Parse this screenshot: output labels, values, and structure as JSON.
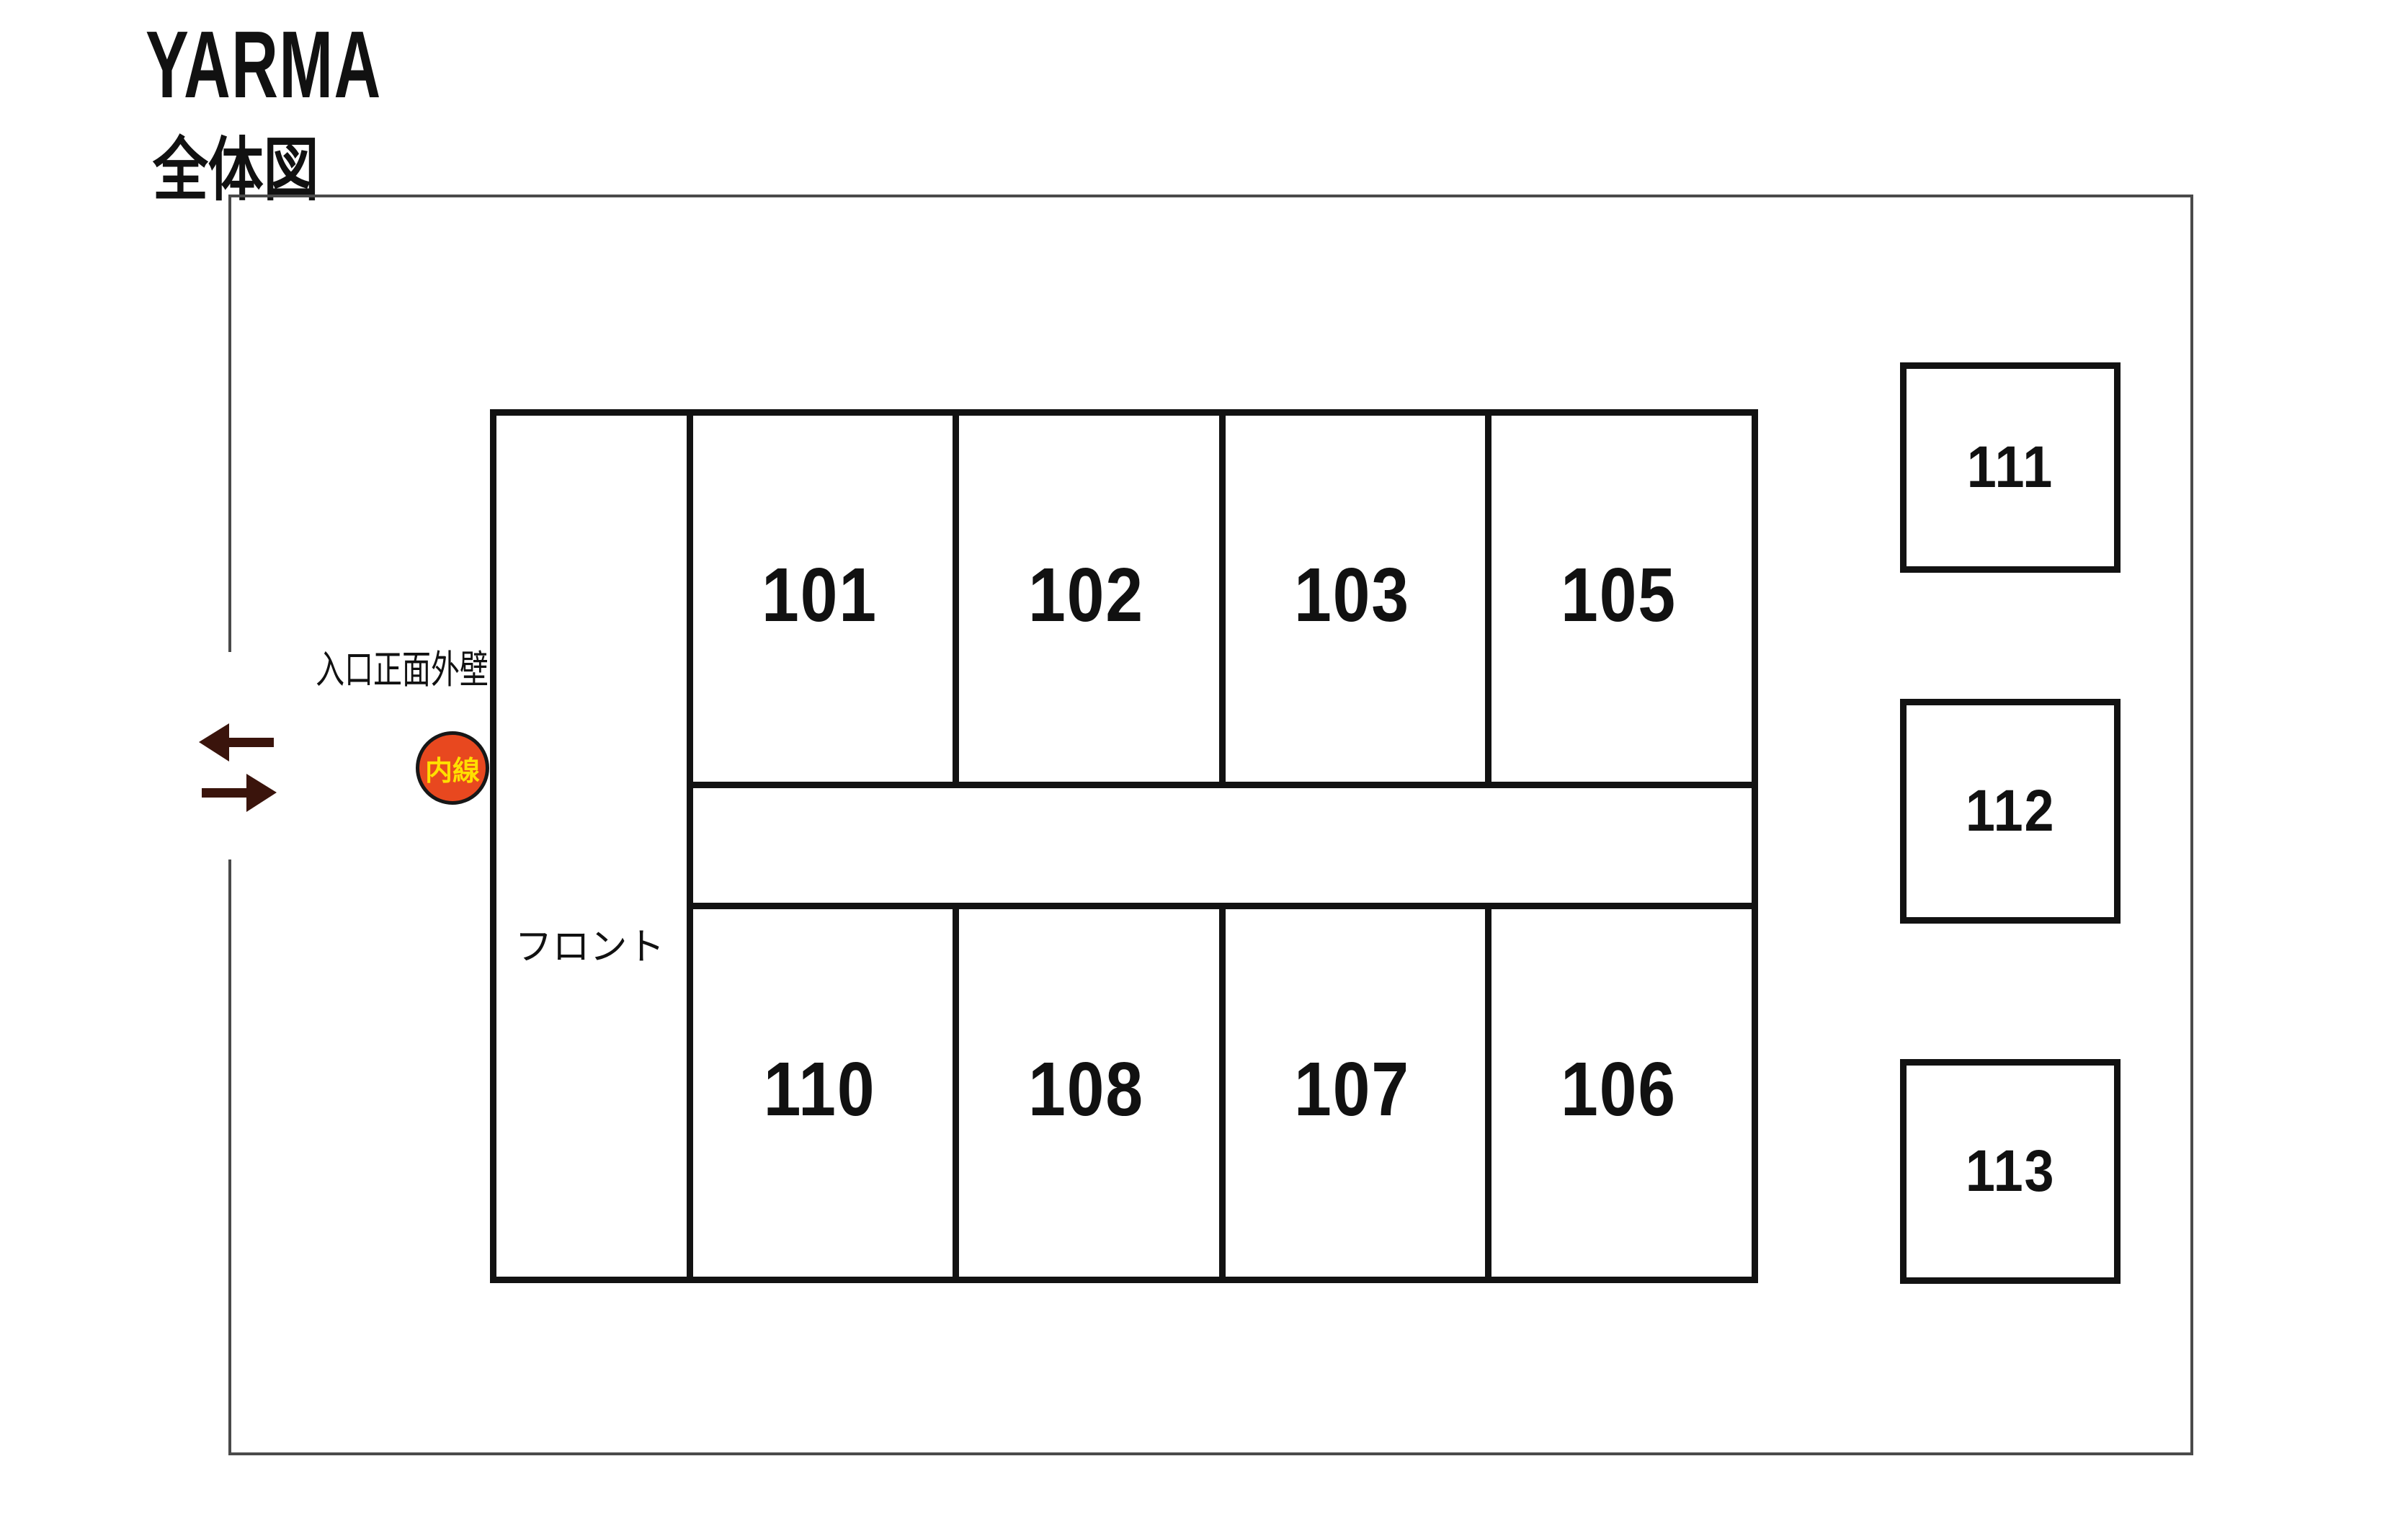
{
  "header": {
    "title": "YARMA",
    "subtitle": "全体図"
  },
  "plan": {
    "entrance_wall_label": "入口正面外壁",
    "extension_badge": "内線",
    "front_desk_label": "フロント",
    "rooms_top_row": [
      "101",
      "102",
      "103",
      "105"
    ],
    "rooms_bottom_row": [
      "110",
      "108",
      "107",
      "106"
    ],
    "rooms_detached": [
      "111",
      "112",
      "113"
    ],
    "entrance_arrows": [
      "out-arrow-left",
      "in-arrow-right"
    ]
  },
  "colors": {
    "wall": "#121212",
    "site_boundary": "#4a4a4a",
    "arrow": "#3a140c",
    "extension_badge_bg": "#e8481f",
    "extension_badge_border": "#171717",
    "extension_badge_text": "#ffdf00",
    "text": "#111111",
    "background": "#ffffff"
  }
}
